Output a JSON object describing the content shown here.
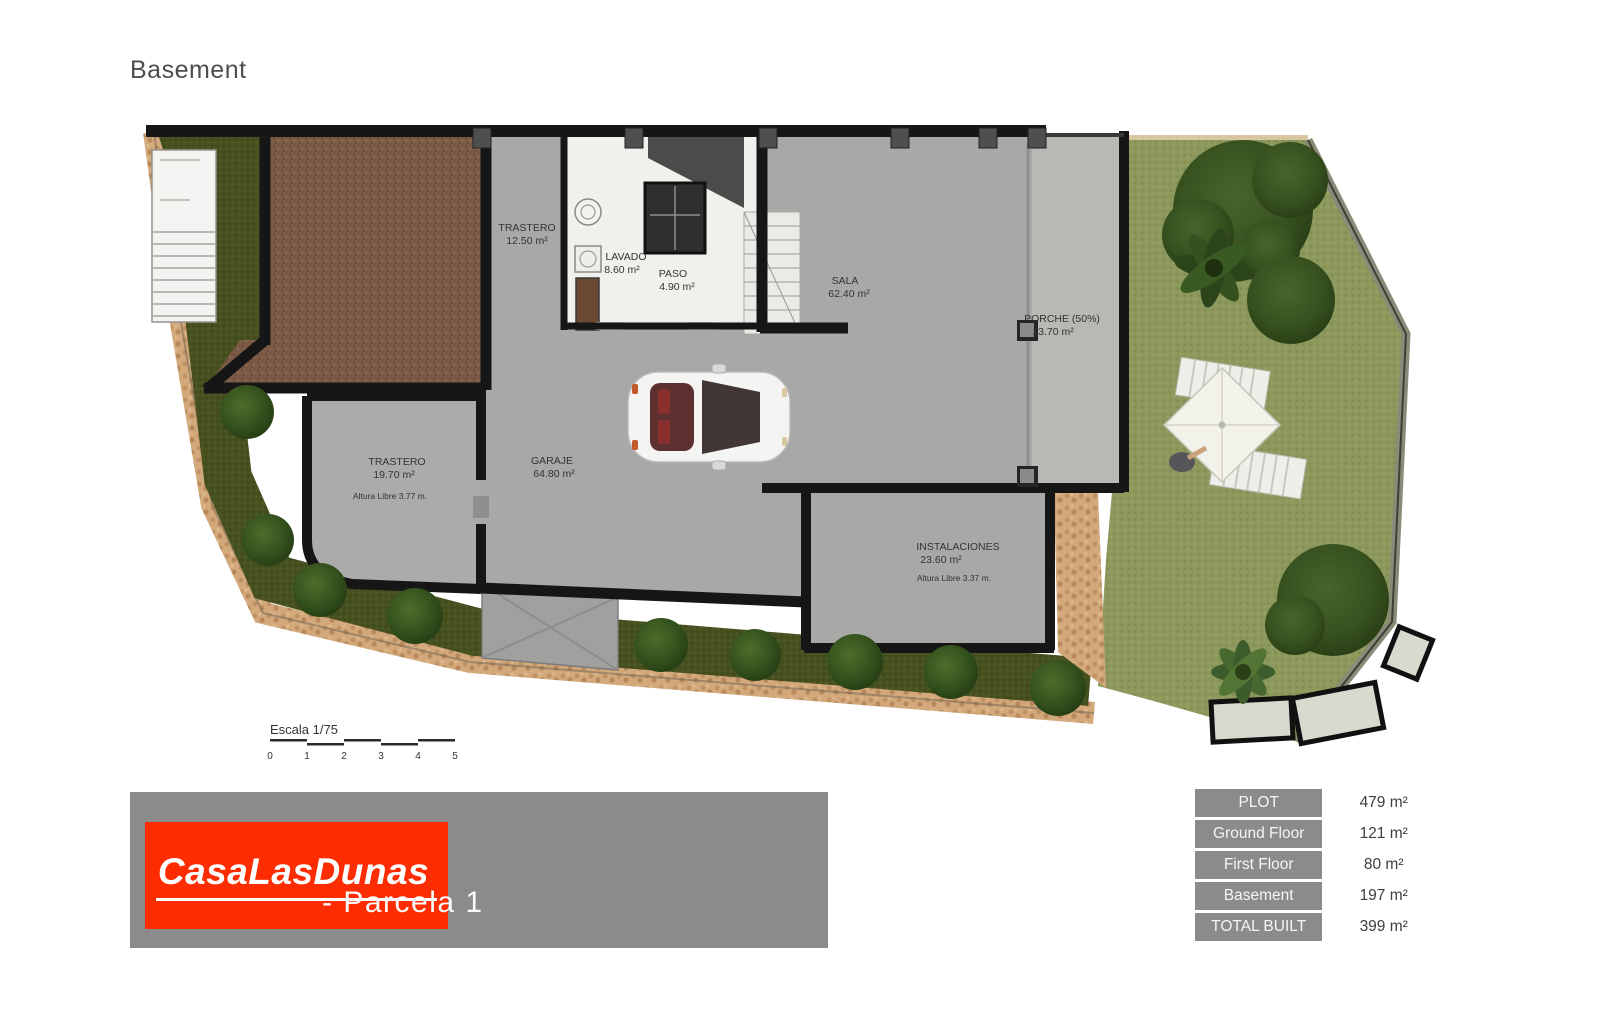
{
  "page": {
    "title": "Basement"
  },
  "plan": {
    "rooms": [
      {
        "name": "TRASTERO",
        "area": "12.50 m²"
      },
      {
        "name": "LAVADO",
        "area": "8.60 m²"
      },
      {
        "name": "PASO",
        "area": "4.90 m²"
      },
      {
        "name": "SALA",
        "area": "62.40 m²"
      },
      {
        "name": "PORCHE (50%)",
        "area": "13.70 m²"
      },
      {
        "name": "TRASTERO",
        "area": "19.70 m²",
        "note": "Altura Libre 3.77 m."
      },
      {
        "name": "GARAJE",
        "area": "64.80 m²"
      },
      {
        "name": "INSTALACIONES",
        "area": "23.60 m²",
        "note": "Altura Libre 3.37 m."
      }
    ],
    "scale": {
      "label": "Escala 1/75",
      "ticks": [
        "0",
        "1",
        "2",
        "3",
        "4",
        "5"
      ]
    }
  },
  "footer": {
    "logo_text": "CasaLasDunas",
    "subtitle": "- Parcela 1",
    "logo_bg": "#fe2c01",
    "banner_bg": "#8b8b8b"
  },
  "summary_table": {
    "rows": [
      {
        "label": "PLOT",
        "value": "479 m²"
      },
      {
        "label": "Ground Floor",
        "value": "121 m²"
      },
      {
        "label": "First Floor",
        "value": "80 m²"
      },
      {
        "label": "Basement",
        "value": "197 m²"
      },
      {
        "label": "TOTAL BUILT",
        "value": "399 m²"
      }
    ]
  },
  "colors": {
    "wall": "#161616",
    "floor_gray": "#a8a8a6",
    "porch_gray": "#b8b8b4",
    "garden_green": "#8d985c",
    "hedge_green": "#46511f",
    "earth_brown": "#7a5a44",
    "stone_path": "#d3a97c",
    "accent_red": "#fe2c01",
    "panel_gray": "#8b8b8b"
  }
}
